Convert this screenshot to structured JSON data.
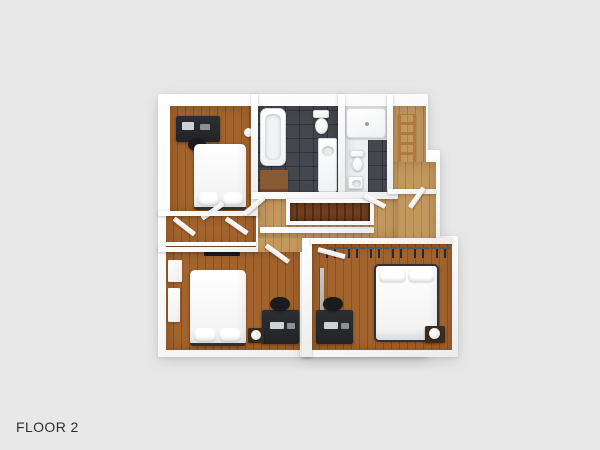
{
  "page": {
    "floor_label": "FLOOR 2"
  },
  "plan": {
    "colors": {
      "background": "#e8e8e8",
      "wall": "#f8f8f8",
      "wood_bedroom": "#a2632d",
      "wood_bedroom_dark": "#8a5124",
      "wood_hall": "#c3985f",
      "wood_hall_dark": "#ad8149",
      "wood_stairs": "#6e3e1e",
      "wood_stairs_dark": "#512c13",
      "tile": "#44474d",
      "bath_floor": "#edeff1",
      "furniture_dark": "#222428",
      "wood_cabinet": "#8a5a33",
      "ladder_wood": "#ae7a40",
      "nightstand_wood": "#3c2b1a",
      "bed_white": "#ffffff",
      "label_color": "#2f2f2f"
    },
    "rooms": [
      {
        "id": "bedroom-top-left",
        "type": "bedroom"
      },
      {
        "id": "bathroom-main",
        "type": "bathroom"
      },
      {
        "id": "bathroom-second",
        "type": "bathroom"
      },
      {
        "id": "ladder-closet",
        "type": "closet"
      },
      {
        "id": "hallway-landing",
        "type": "hallway"
      },
      {
        "id": "stairwell",
        "type": "stairs"
      },
      {
        "id": "closet-corridor",
        "type": "closet"
      },
      {
        "id": "bedroom-bottom-left",
        "type": "bedroom"
      },
      {
        "id": "bedroom-bottom-right",
        "type": "bedroom"
      }
    ],
    "furniture": [
      "bed",
      "pillow",
      "desk",
      "office-chair",
      "nightstand",
      "lamp",
      "bathtub",
      "wood-cabinet",
      "toilet",
      "sink-vanity",
      "shower",
      "ladder",
      "closet-rail-hangers",
      "wardrobe",
      "tv-panel",
      "mirror",
      "door-panel"
    ]
  }
}
